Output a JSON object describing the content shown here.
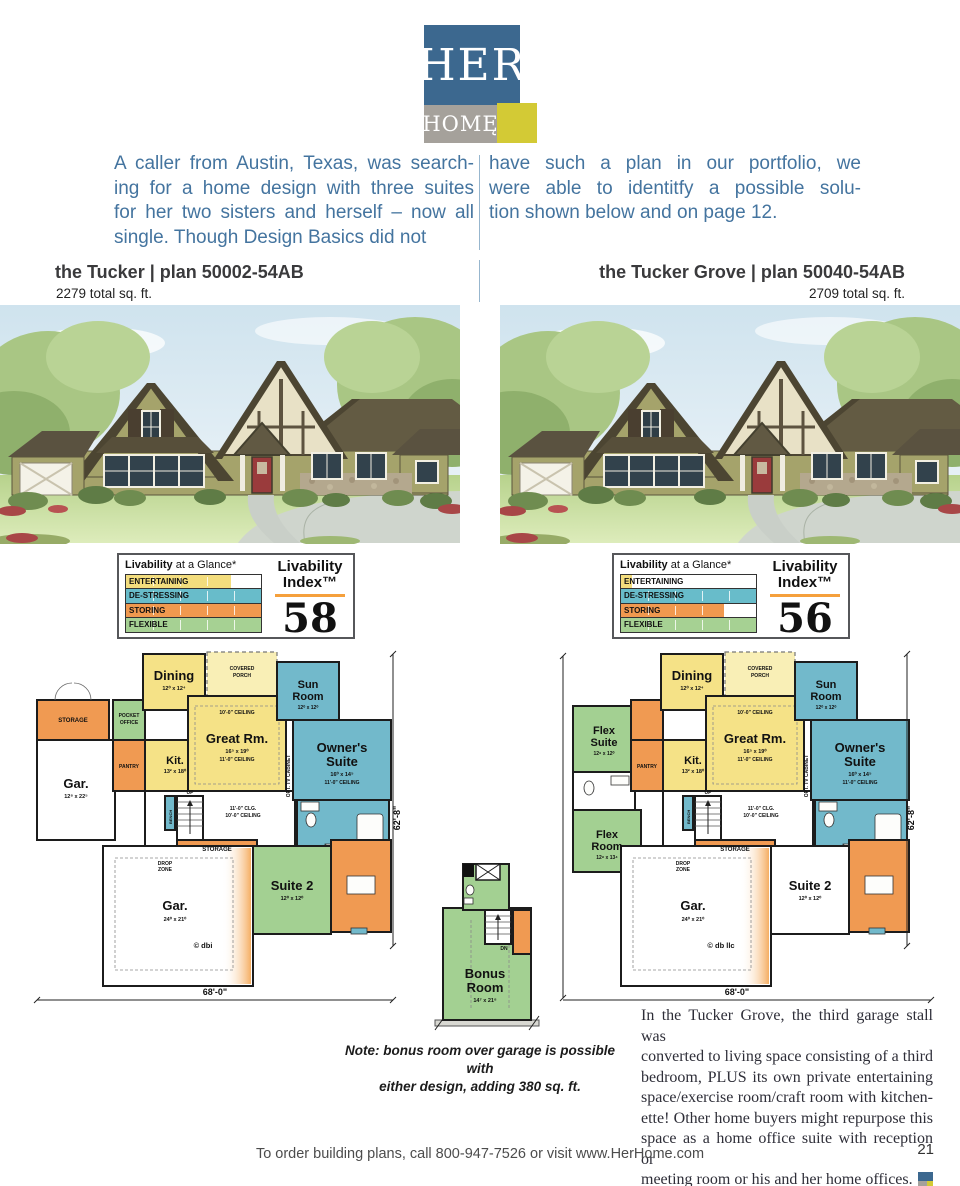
{
  "logo": {
    "her": "HER",
    "home": "HOMĘ"
  },
  "intro": {
    "col1": [
      "A caller from Austin, Texas, was search-",
      "ing for a home design with three suites",
      "for her two sisters and herself – now all",
      "single. Though Design Basics did not"
    ],
    "col2": [
      "have such a plan in our portfolio, we",
      "were able to identitfy a possible solu-",
      "tion shown below and on page 12."
    ]
  },
  "livability": {
    "glance_b": "Livability",
    "glance_r": " at a Glance*",
    "index_1": "Livability",
    "index_2": "Index™"
  },
  "left_plan": {
    "title": "the Tucker | plan 50002-54AB",
    "sqft": "2279 total sq. ft.",
    "index": "58",
    "bars": [
      {
        "label": "ENTERTAINING",
        "color": "#f3dd7d",
        "fill": 78
      },
      {
        "label": "DE-STRESSING",
        "color": "#68bcca",
        "fill": 100
      },
      {
        "label": "STORING",
        "color": "#f0994f",
        "fill": 100
      },
      {
        "label": "FLEXIBLE",
        "color": "#a6d193",
        "fill": 100
      }
    ],
    "copyright": "© dbi",
    "pocket_1": "POCKET",
    "pocket_2": "OFFICE",
    "gar_small_n": "Gar.",
    "gar_small_s": "12⁸ x 22⁵"
  },
  "right_plan": {
    "title": "the Tucker Grove | plan 50040-54AB",
    "sqft": "2709 total sq. ft.",
    "index": "56",
    "bars": [
      {
        "label": "ENTERTAINING",
        "color": "#f3dd7d",
        "fill": 8
      },
      {
        "label": "DE-STRESSING",
        "color": "#68bcca",
        "fill": 100
      },
      {
        "label": "STORING",
        "color": "#f0994f",
        "fill": 76
      },
      {
        "label": "FLEXIBLE",
        "color": "#a6d193",
        "fill": 100
      }
    ],
    "copyright": "© db llc",
    "flex_suite_1": "Flex",
    "flex_suite_2": "Suite",
    "flex_suite_s": "12⁸ x 12⁰",
    "flex_room_1": "Flex",
    "flex_room_2": "Room",
    "flex_room_s": "12⁸ x 13⁴"
  },
  "rooms": {
    "dining_n": "Dining",
    "dining_s": "12⁰ x 12⁴",
    "porch_1": "COVERED",
    "porch_2": "PORCH",
    "great_n": "Great Rm.",
    "great_s": "16⁵ x 19⁰",
    "great_c": "11'-0\" CEILING",
    "ceil10": "10'-0\" CEILING",
    "clg11": "11'-0\" CLG.",
    "kit_n": "Kit.",
    "kit_s": "13² x 18⁰",
    "pantry": "PANTRY",
    "sun_1": "Sun",
    "sun_2": "Room",
    "sun_s": "12⁰ x 12⁰",
    "own_1": "Owner's",
    "own_2": "Suite",
    "own_s": "16⁰ x 14⁵",
    "own_c": "11'-0\" CEILING",
    "suite2_n": "Suite 2",
    "suite2_s": "12⁰ x 12⁰",
    "storage": "STORAGE",
    "drop_1": "DROP",
    "drop_2": "ZONE",
    "bench": "BENCH",
    "up": "UP",
    "opt_tv": "OPT. TV CABINET",
    "gar_n": "Gar.",
    "gar_big_s": "24⁰ x 21⁰"
  },
  "dims": {
    "w": "68'-0\"",
    "h": "62'-8\""
  },
  "bonus": {
    "n1": "Bonus",
    "n2": "Room",
    "s": "14⁷ x 21⁸",
    "dn": "DN",
    "note": [
      "Note: bonus room over garage is possible with",
      "either design, adding 380 sq. ft."
    ]
  },
  "aside": [
    "In the Tucker Grove, the third garage stall was",
    "converted to living space consisting of a third",
    "bedroom, PLUS its own private entertaining",
    "space/exercise room/craft room with kitchen-",
    "ette! Other home buyers might repurpose this",
    "space as a home office suite with reception or",
    "meeting room or his and her home offices."
  ],
  "footer": {
    "text": "To order building plans, call 800-947-7526 or visit www.HerHome.com",
    "page": "21"
  }
}
